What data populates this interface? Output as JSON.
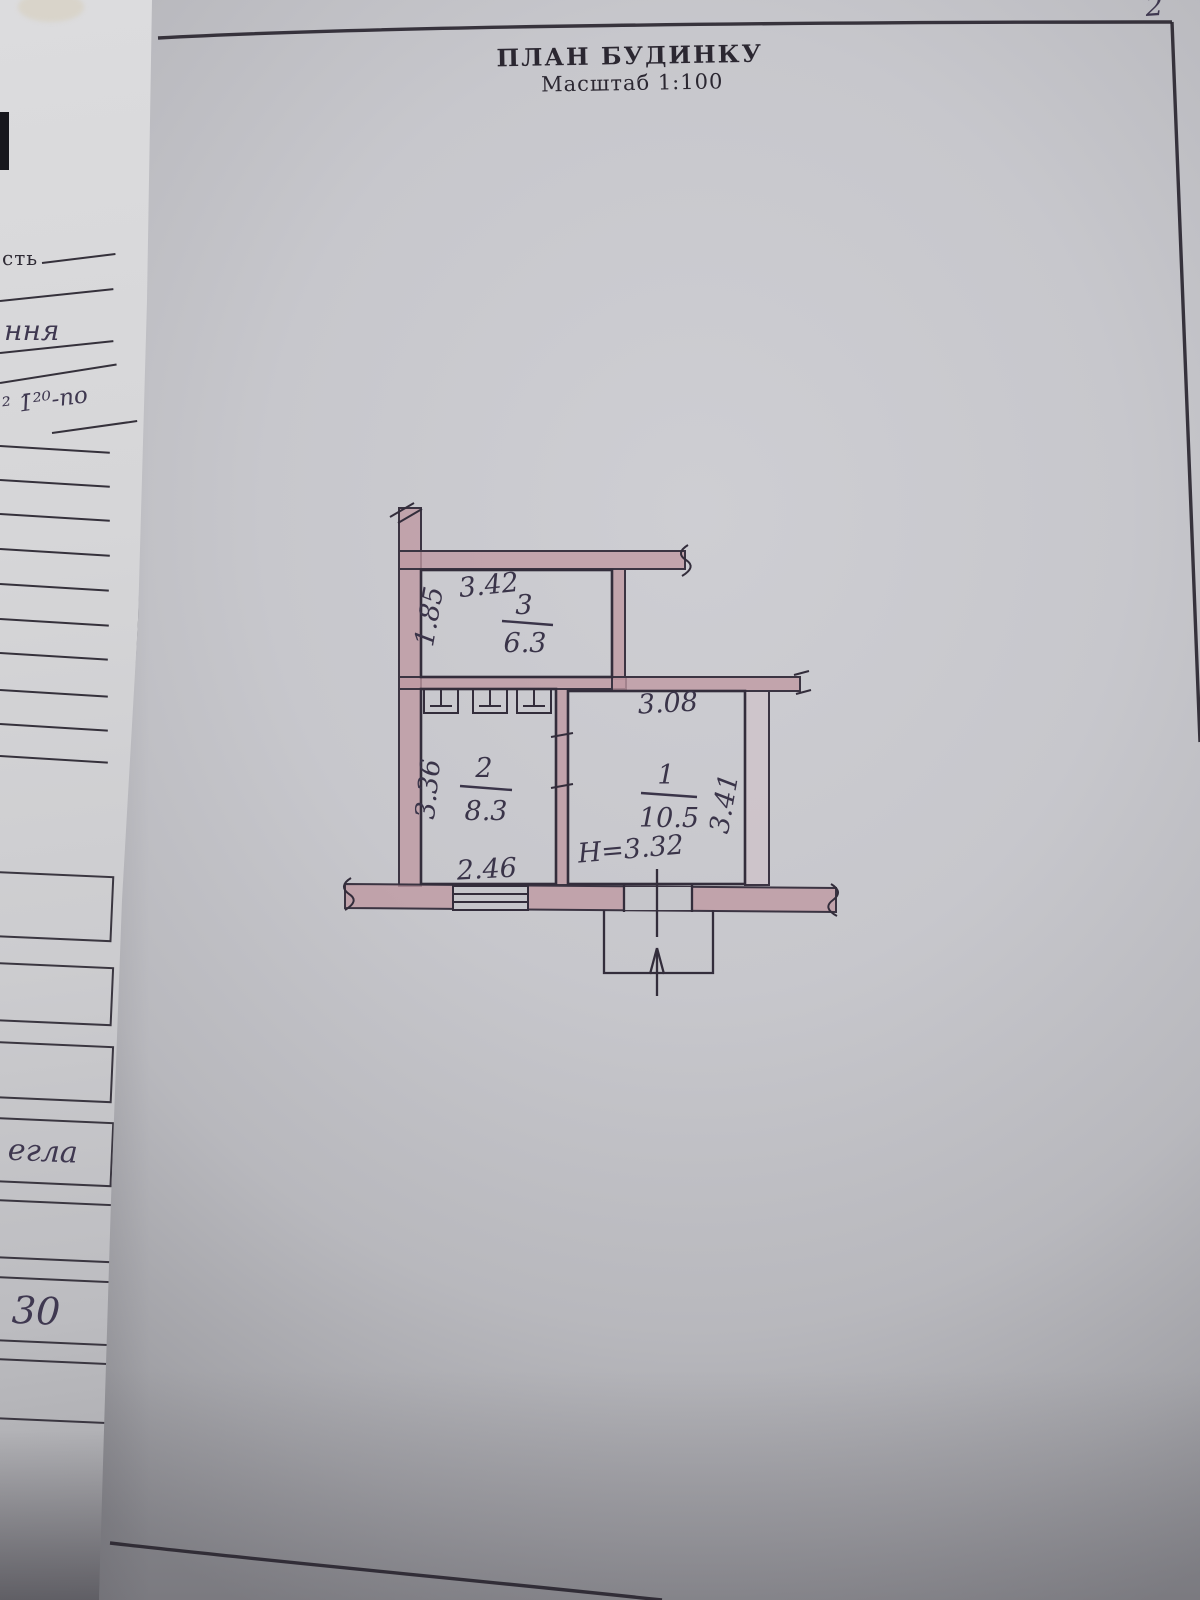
{
  "photo": {
    "page_number": "2"
  },
  "header": {
    "title": "ПЛАН БУДИНКУ",
    "scale": "Масштаб 1:100"
  },
  "plan": {
    "ceiling_note": "H=3.32",
    "rooms": [
      {
        "number": "1",
        "area": "10.5",
        "dim_top": "3.08",
        "dim_side": "3.41"
      },
      {
        "number": "2",
        "area": "8.3",
        "dim_side": "3.36",
        "dim_bottom": "2.46"
      },
      {
        "number": "3",
        "area": "6.3",
        "dim_top": "3.42",
        "dim_side": "1.85"
      }
    ]
  },
  "side_page": {
    "label_1": "сть",
    "label_2": "ння",
    "label_3": "² 1̄²⁰-по",
    "label_4": "егла",
    "label_5": "30"
  },
  "colors": {
    "paper": "#c7c7cc",
    "side_paper": "#d7d7d9",
    "ink": "#2d2933",
    "wall_tint": "#bf98a2",
    "handwriting": "#3a3449"
  }
}
